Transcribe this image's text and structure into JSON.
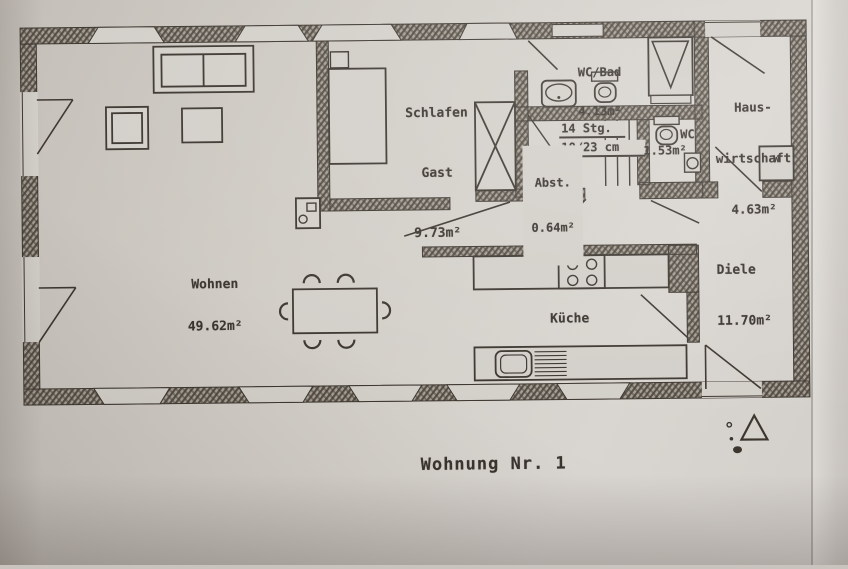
{
  "plan": {
    "caption": "Wohnung Nr. 1",
    "labels": {
      "wohnen": {
        "l1": "Wohnen",
        "l2": "49.62m²"
      },
      "schlafen": {
        "l1": "Schlafen",
        "l2": "Gast",
        "l3": "9.73m²"
      },
      "wcbad": {
        "l1": "WC/Bad",
        "l2": "4.13m²"
      },
      "haus": {
        "l1": "Haus-",
        "l2": "wirtschaft",
        "l3": "4.63m²"
      },
      "wc": {
        "l1": "WC",
        "l2": "1.53m²"
      },
      "stairs": {
        "l1": "14 Stg.",
        "l2": "18/23 cm"
      },
      "abst": {
        "l1": "Abst.",
        "l2": "0.64m²"
      },
      "diele": {
        "l1": "Diele",
        "l2": "11.70m²"
      },
      "kueche": {
        "l1": "Küche"
      },
      "washer": {
        "l1": "W"
      }
    },
    "colors": {
      "paper": "#d3cfc9",
      "ink": "#3c362f",
      "wall_fill": "#a49d93"
    }
  }
}
